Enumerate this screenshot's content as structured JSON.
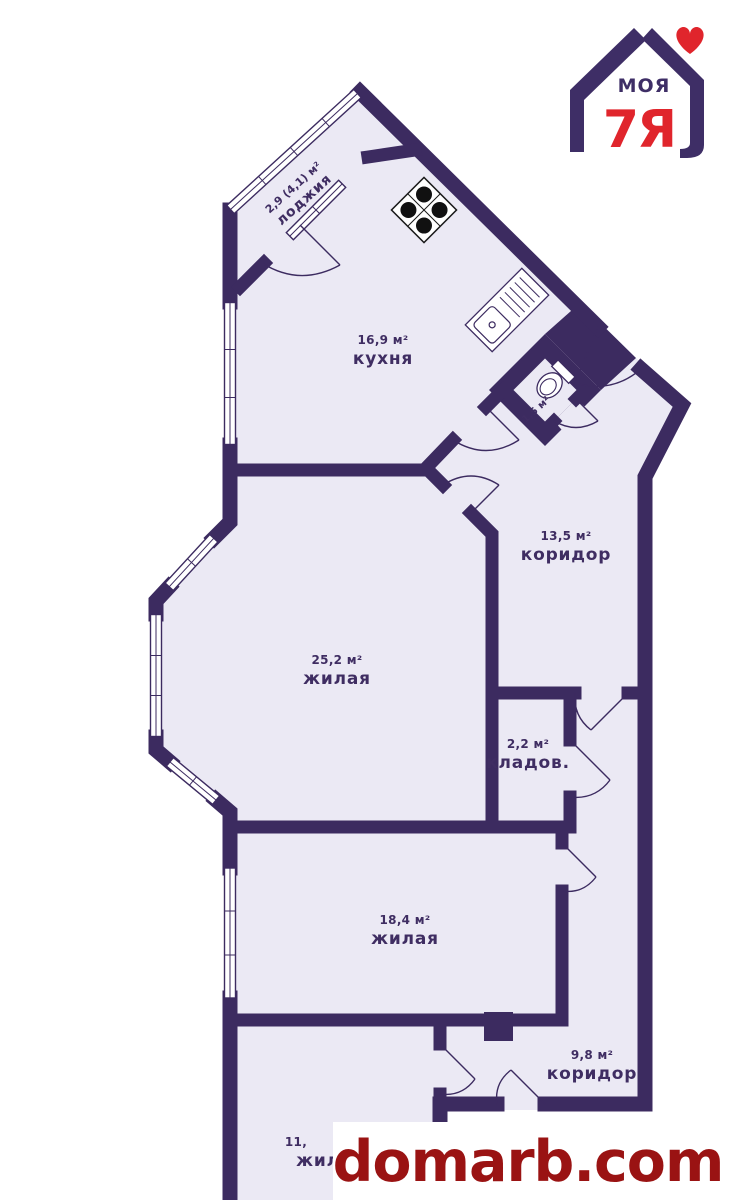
{
  "palette": {
    "wall": "#3c2b60",
    "room_fill": "#ebe9f4",
    "outside": "#ffffff",
    "label": "#3f2d62",
    "logo_purple": "#3e2e66",
    "logo_red": "#e0252c",
    "watermark_red": "#9a1313"
  },
  "logo": {
    "top_text": "МОЯ",
    "main_text": "7Я"
  },
  "watermark": {
    "text": "domarb.com"
  },
  "rooms": [
    {
      "area": "2,9 (4,1) м²",
      "name": "лоджия"
    },
    {
      "area": "16,9 м²",
      "name": "кухня"
    },
    {
      "area": "1,5 м²",
      "name": ""
    },
    {
      "area": "13,5 м²",
      "name": "коридор"
    },
    {
      "area": "25,2 м²",
      "name": "жилая"
    },
    {
      "area": "2,2 м²",
      "name": "кладов."
    },
    {
      "area": "18,4 м²",
      "name": "жилая"
    },
    {
      "area": "9,8 м²",
      "name": "коридор"
    },
    {
      "area": "11,",
      "name": "жилая"
    }
  ],
  "icons": {
    "stove": "stove-icon",
    "sink": "sink-icon",
    "toilet": "toilet-icon"
  }
}
